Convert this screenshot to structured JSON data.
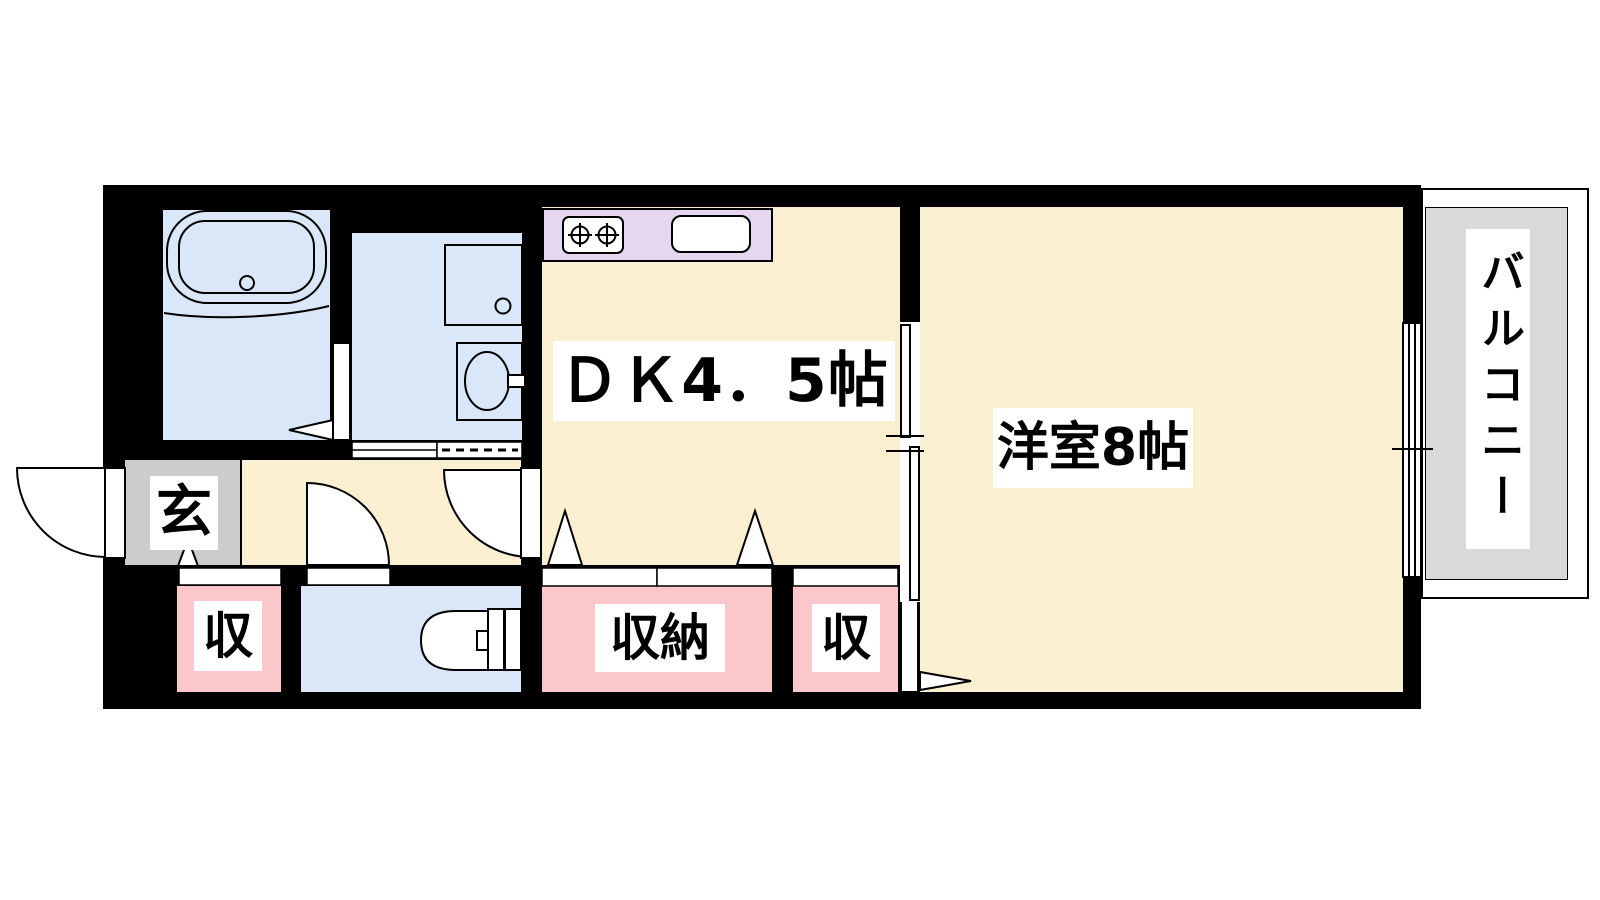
{
  "plan": {
    "type": "apartment-floorplan",
    "rooms": {
      "dk": {
        "label": "ＤＫ4．5帖"
      },
      "western_room": {
        "label": "洋室8帖"
      },
      "balcony": {
        "label": "バルコニー"
      },
      "entrance": {
        "label": "玄"
      },
      "closet_left": {
        "label": "収"
      },
      "closet_center": {
        "label": "収納"
      },
      "closet_right": {
        "label": "収"
      }
    },
    "colors": {
      "wall": "#000000",
      "floor": "#FBEFD1",
      "wet_area": "#D9E7F8",
      "kitchen_counter": "#E5D7F0",
      "closet": "#FCC7CB",
      "entrance_floor": "#CCCCCC",
      "balcony_floor": "#D9D9D9",
      "line": "#000000",
      "label_bg": "#FFFFFF"
    }
  }
}
